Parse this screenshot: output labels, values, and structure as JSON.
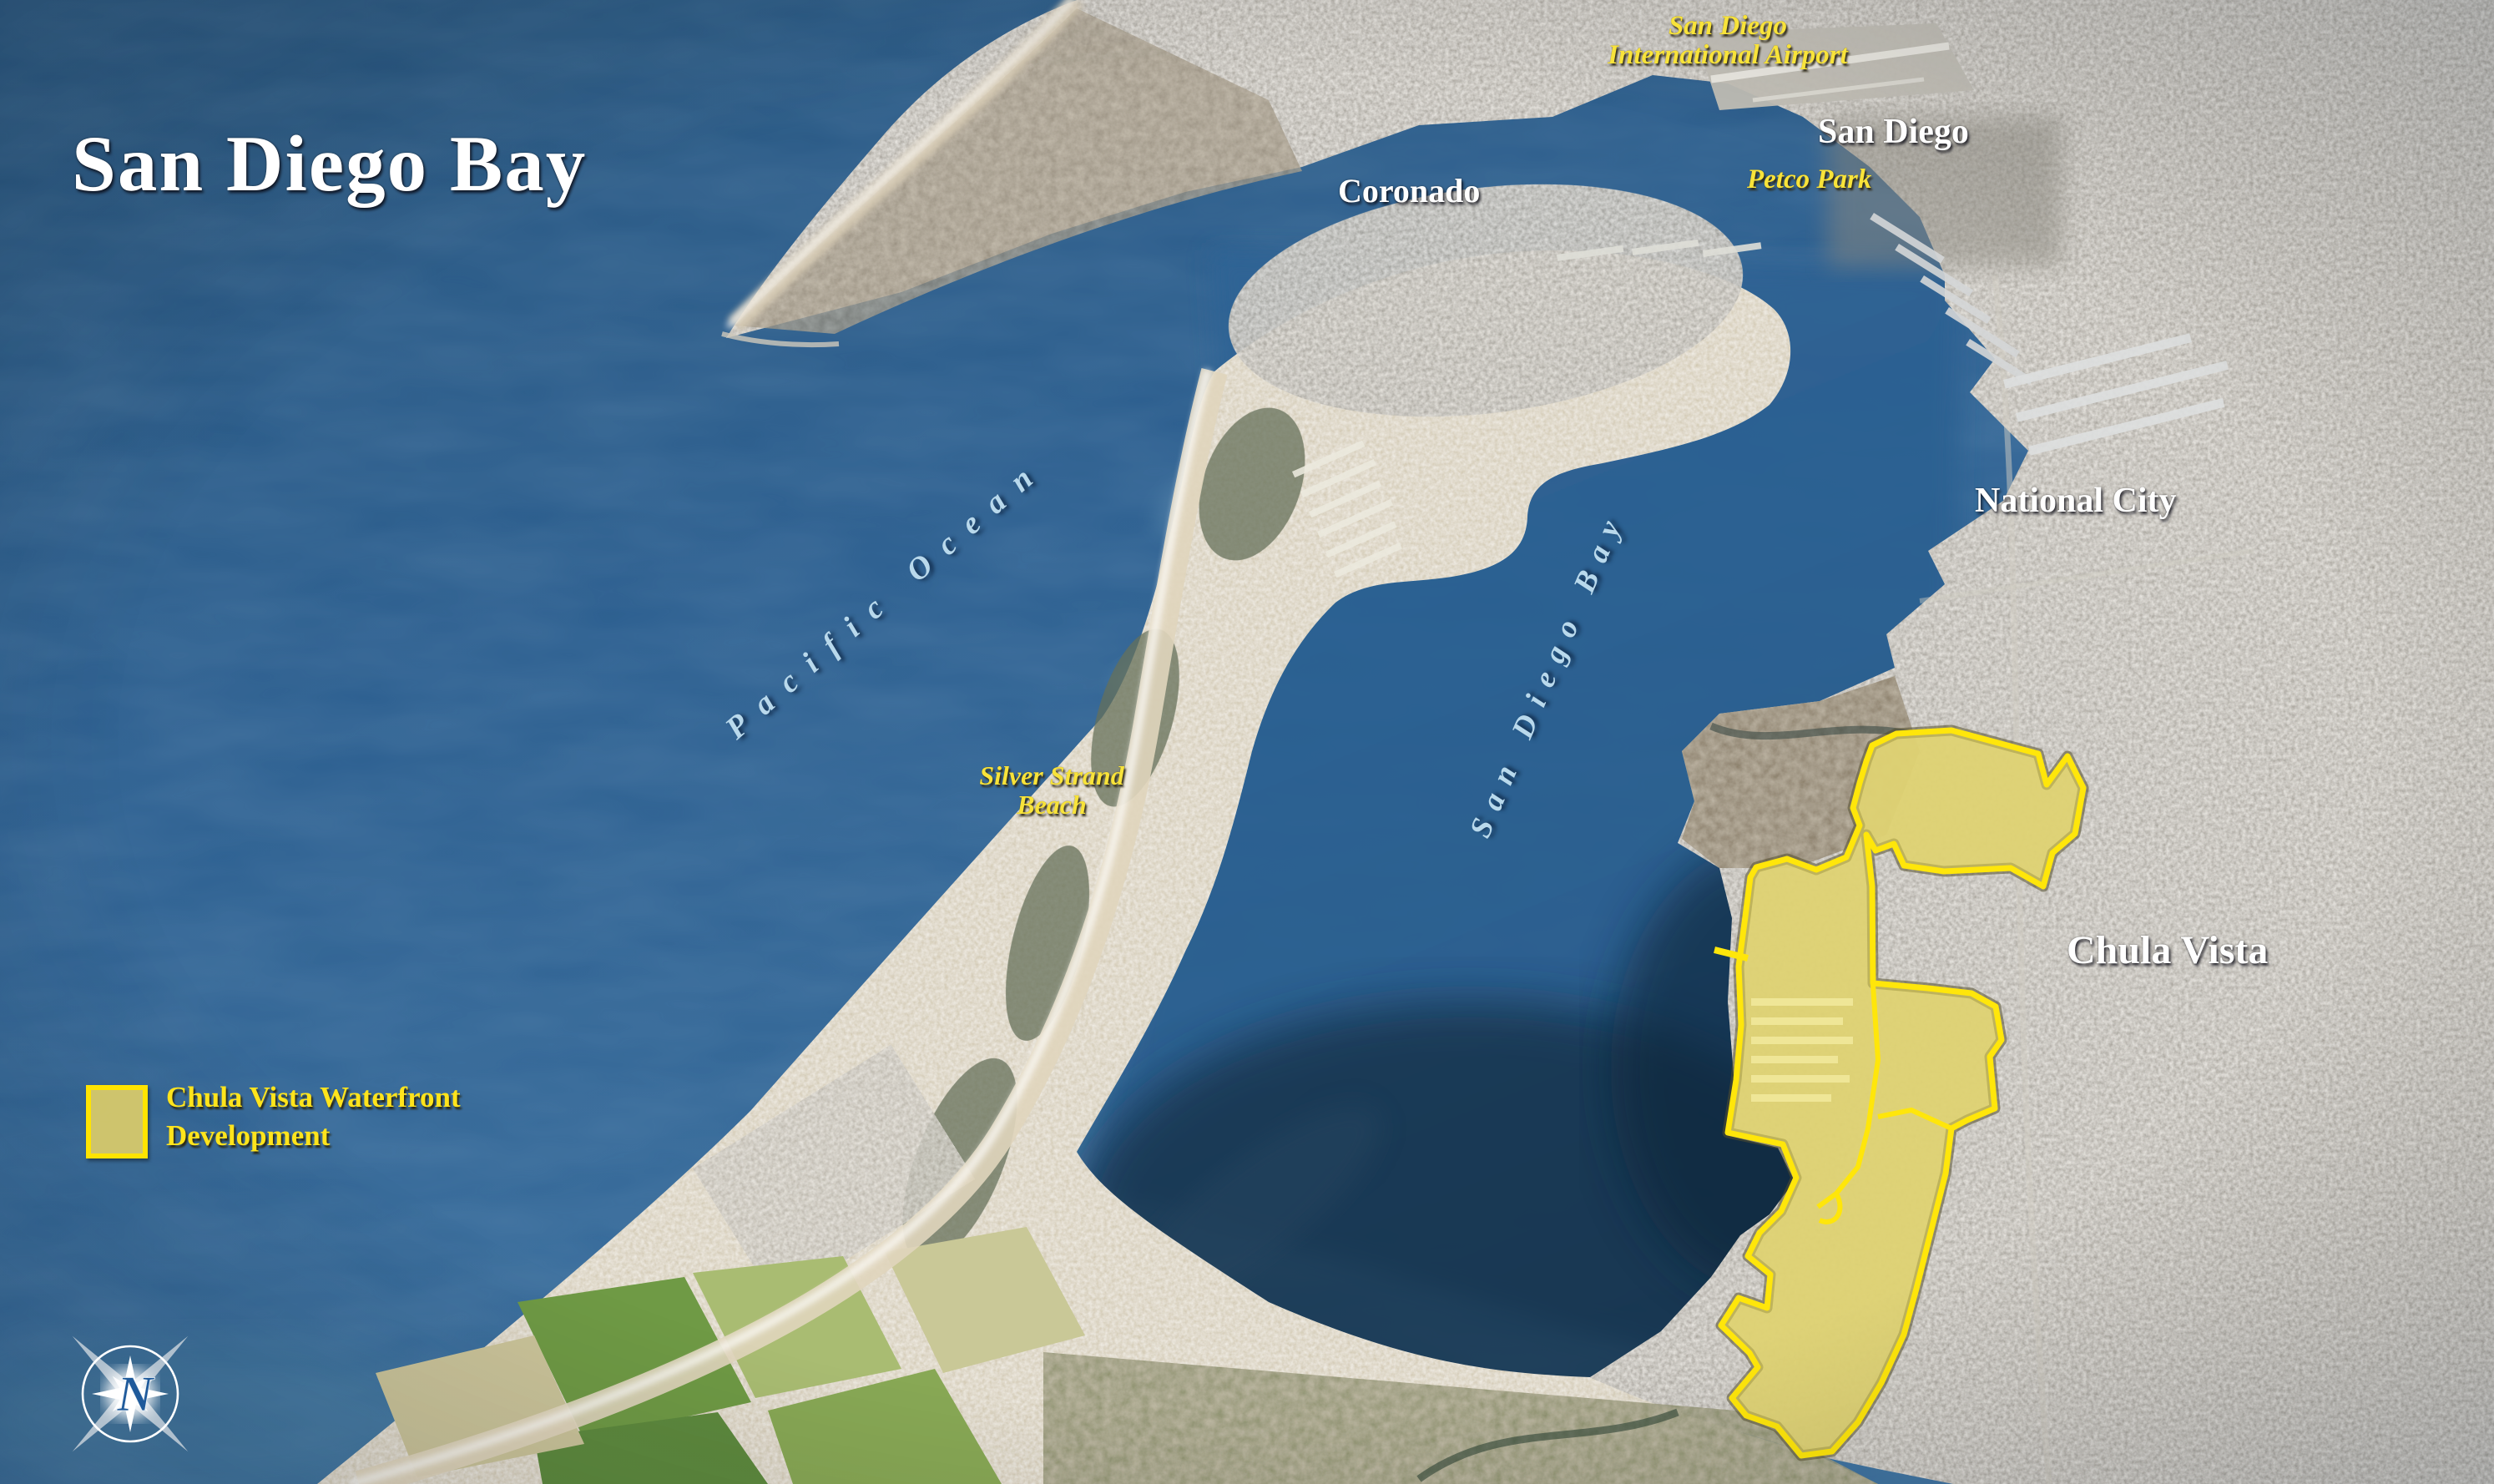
{
  "title": "San Diego Bay",
  "labels": {
    "airport": {
      "line1": "San Diego",
      "line2": "International Airport"
    },
    "san_diego": "San Diego",
    "petco_park": "Petco Park",
    "coronado": "Coronado",
    "national_city": "National City",
    "pacific_ocean": "Pacific Ocean",
    "bay": "San Diego Bay",
    "silver_strand": {
      "line1": "Silver Strand",
      "line2": "Beach"
    },
    "chula_vista": "Chula Vista"
  },
  "legend": {
    "line1": "Chula Vista Waterfront",
    "line2": "Development",
    "swatch_fill": "#dbcc69",
    "swatch_border": "#ffe400"
  },
  "compass": {
    "letter": "N"
  },
  "colors": {
    "ocean": "#2c5f90",
    "bay": "#2e6394",
    "urban_land": "#a29e96",
    "sand": "#d8cdb2",
    "highlight_fill": "#e7d96b",
    "highlight_border": "#ffe60a",
    "label_yellow": "#f8e33a",
    "label_white": "#ffffff",
    "water_label_blue": "#b9d9ec"
  }
}
